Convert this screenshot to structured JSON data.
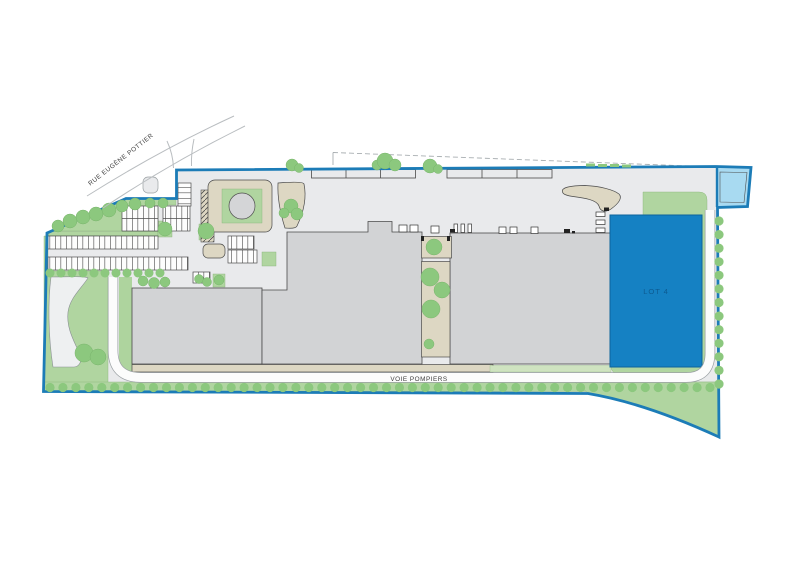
{
  "labels": {
    "street": "RUE EUGÈNE POTTIER",
    "fire_lane": "VOIE POMPIERS",
    "lot4": "LOT 4"
  },
  "colors": {
    "boundary": "#1c7cb7",
    "lot_fill": "#1581c3",
    "lot_border": "#0d649c",
    "lot_label": "#0d5b92",
    "basin_fill": "#a8daf1",
    "green": "#b0d5a0",
    "bush": "#8cc87e",
    "building": "#d2d3d5",
    "pavement": "#e9eaec"
  }
}
